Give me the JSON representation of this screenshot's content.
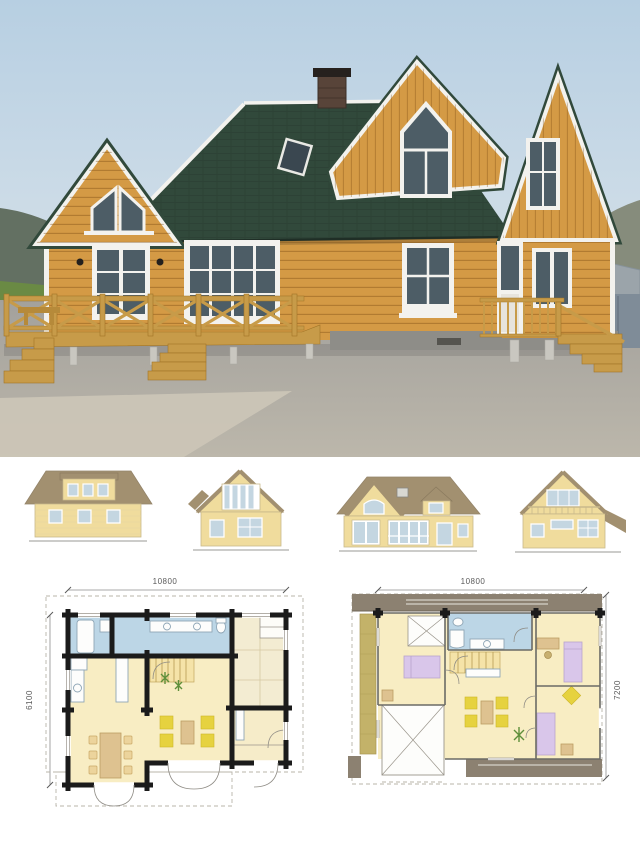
{
  "plans": {
    "first_floor": {
      "width_label": "10800",
      "depth_label": "6100"
    },
    "second_floor": {
      "width_label": "10800",
      "depth_label": "7200"
    }
  },
  "colors": {
    "sky_top": "#b7cfe2",
    "sky_bottom": "#dbe5ec",
    "roof_green": "#31493b",
    "wall_wood": "#d49a45",
    "trim": "#f3f2ee",
    "glass": "#4d5d66",
    "deck_wood": "#c79b49",
    "deck_dark": "#a07427",
    "gravel_top": "#a3a19c",
    "gravel_bottom": "#bcb7ab",
    "sand": "#cbc5b6",
    "hill_left": "#46523e",
    "hill_right": "#73765f",
    "field_green": "#6a8a44",
    "shed_wall": "#7f8c98",
    "shed_roof": "#9ba4aa",
    "foundation": "#8e8d88",
    "elev_roof": "#a29070",
    "elev_wall": "#f0dc9d",
    "elev_window": "#c4d6e1",
    "plan_wall": "#1b1b1b",
    "plan_floor": "#f8edc3",
    "plan_wet": "#bcd6e6",
    "plan_tatami": "#f3ecd2",
    "plan_roof_band": "#8c8171",
    "plan_balcony": "#c3b269",
    "plan_sofa": "#e6d23f",
    "plan_bed": "#d9c6ea",
    "plan_wood": "#dec290",
    "plan_stairs": "#f5e3a8"
  }
}
